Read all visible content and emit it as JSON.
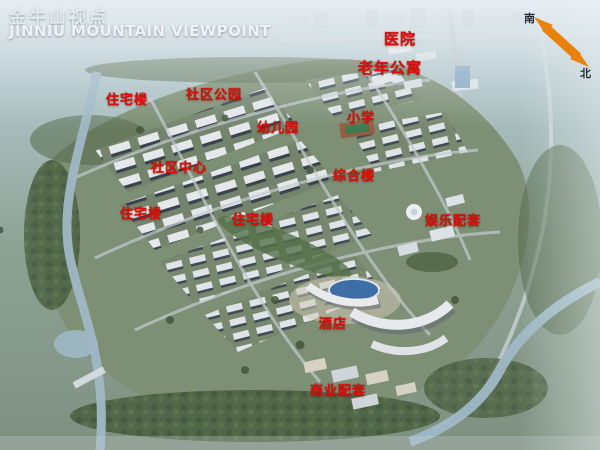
{
  "header": {
    "title_cn": "金牛山视点",
    "title_en": "JINNIU MOUNTAIN VIEWPOINT"
  },
  "compass": {
    "south_label": "南",
    "north_label": "北",
    "arrow_color": "#e8820c"
  },
  "map_labels": [
    {
      "text": "医院",
      "x": 384,
      "y": 32
    },
    {
      "text": "老年公寓",
      "x": 358,
      "y": 61
    },
    {
      "text": "住宅楼",
      "x": 106,
      "y": 94
    },
    {
      "text": "社区公园",
      "x": 186,
      "y": 89
    },
    {
      "text": "幼儿园",
      "x": 257,
      "y": 122
    },
    {
      "text": "小学",
      "x": 347,
      "y": 112
    },
    {
      "text": "社区中心",
      "x": 151,
      "y": 162
    },
    {
      "text": "综合楼",
      "x": 333,
      "y": 170
    },
    {
      "text": "住宅楼",
      "x": 120,
      "y": 208
    },
    {
      "text": "住宅楼",
      "x": 232,
      "y": 214
    },
    {
      "text": "娱乐配套",
      "x": 425,
      "y": 215
    },
    {
      "text": "酒店",
      "x": 319,
      "y": 318
    },
    {
      "text": "商业配套",
      "x": 310,
      "y": 385
    }
  ],
  "colors": {
    "label_red": "#d9100a",
    "title_white": "#eef3f6",
    "compass_orange": "#e8820c"
  }
}
